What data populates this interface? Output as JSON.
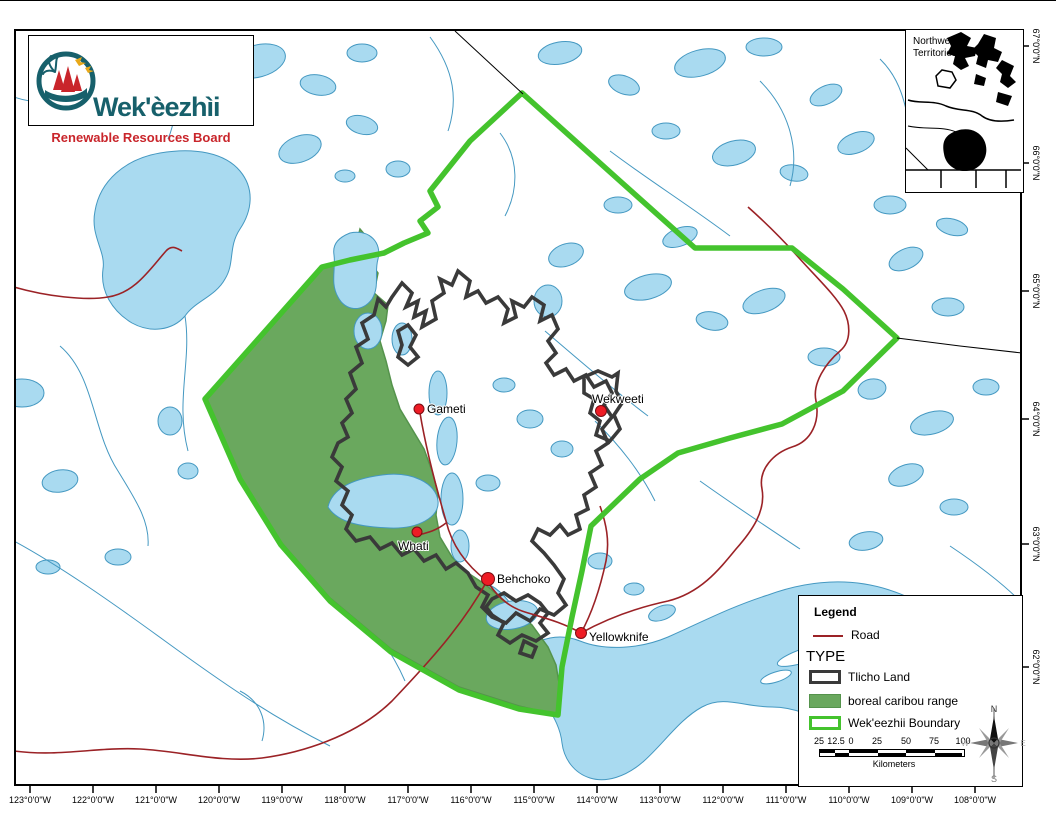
{
  "logo": {
    "title": "Wek'èezhìi",
    "subtitle": "Renewable Resources Board"
  },
  "inset": {
    "line1": "Northwest",
    "line2": "Territories"
  },
  "towns": [
    {
      "name": "Gameti"
    },
    {
      "name": "Wekweeti"
    },
    {
      "name": "Whati"
    },
    {
      "name": "Behchoko"
    },
    {
      "name": "Yellowknife"
    }
  ],
  "legend": {
    "title": "Legend",
    "road_label": "Road",
    "type_heading": "TYPE",
    "items": [
      {
        "label": "Tlicho Land"
      },
      {
        "label": "boreal caribou range"
      },
      {
        "label": "Wek'eezhii Boundary"
      }
    ]
  },
  "scalebar": {
    "labels": [
      "25",
      "12.5",
      "0",
      "25",
      "50",
      "75",
      "100"
    ],
    "unit": "Kilometers"
  },
  "compass": {
    "n": "N",
    "e": "E",
    "s": "S",
    "w": "W"
  },
  "axes": {
    "lon": [
      "123°0'0\"W",
      "122°0'0\"W",
      "121°0'0\"W",
      "120°0'0\"W",
      "119°0'0\"W",
      "118°0'0\"W",
      "117°0'0\"W",
      "116°0'0\"W",
      "115°0'0\"W",
      "114°0'0\"W",
      "113°0'0\"W",
      "112°0'0\"W",
      "111°0'0\"W",
      "110°0'0\"W",
      "109°0'0\"W",
      "108°0'0\"W"
    ],
    "lat": [
      "67°0'0\"N",
      "66°0'0\"N",
      "65°0'0\"N",
      "64°0'0\"N",
      "63°0'0\"N",
      "62°0'0\"N"
    ]
  },
  "colors": {
    "wekeezhii_boundary": "#44c32d",
    "caribou_range": "#6aa85e",
    "tlicho_land": "#3a3a3a",
    "road": "#9b2226",
    "lake_fill": "#a9daf0",
    "lake_stroke": "#4498c1",
    "town_marker": "#ee1c25",
    "logo_teal": "#17606b",
    "logo_red": "#c9252b"
  }
}
